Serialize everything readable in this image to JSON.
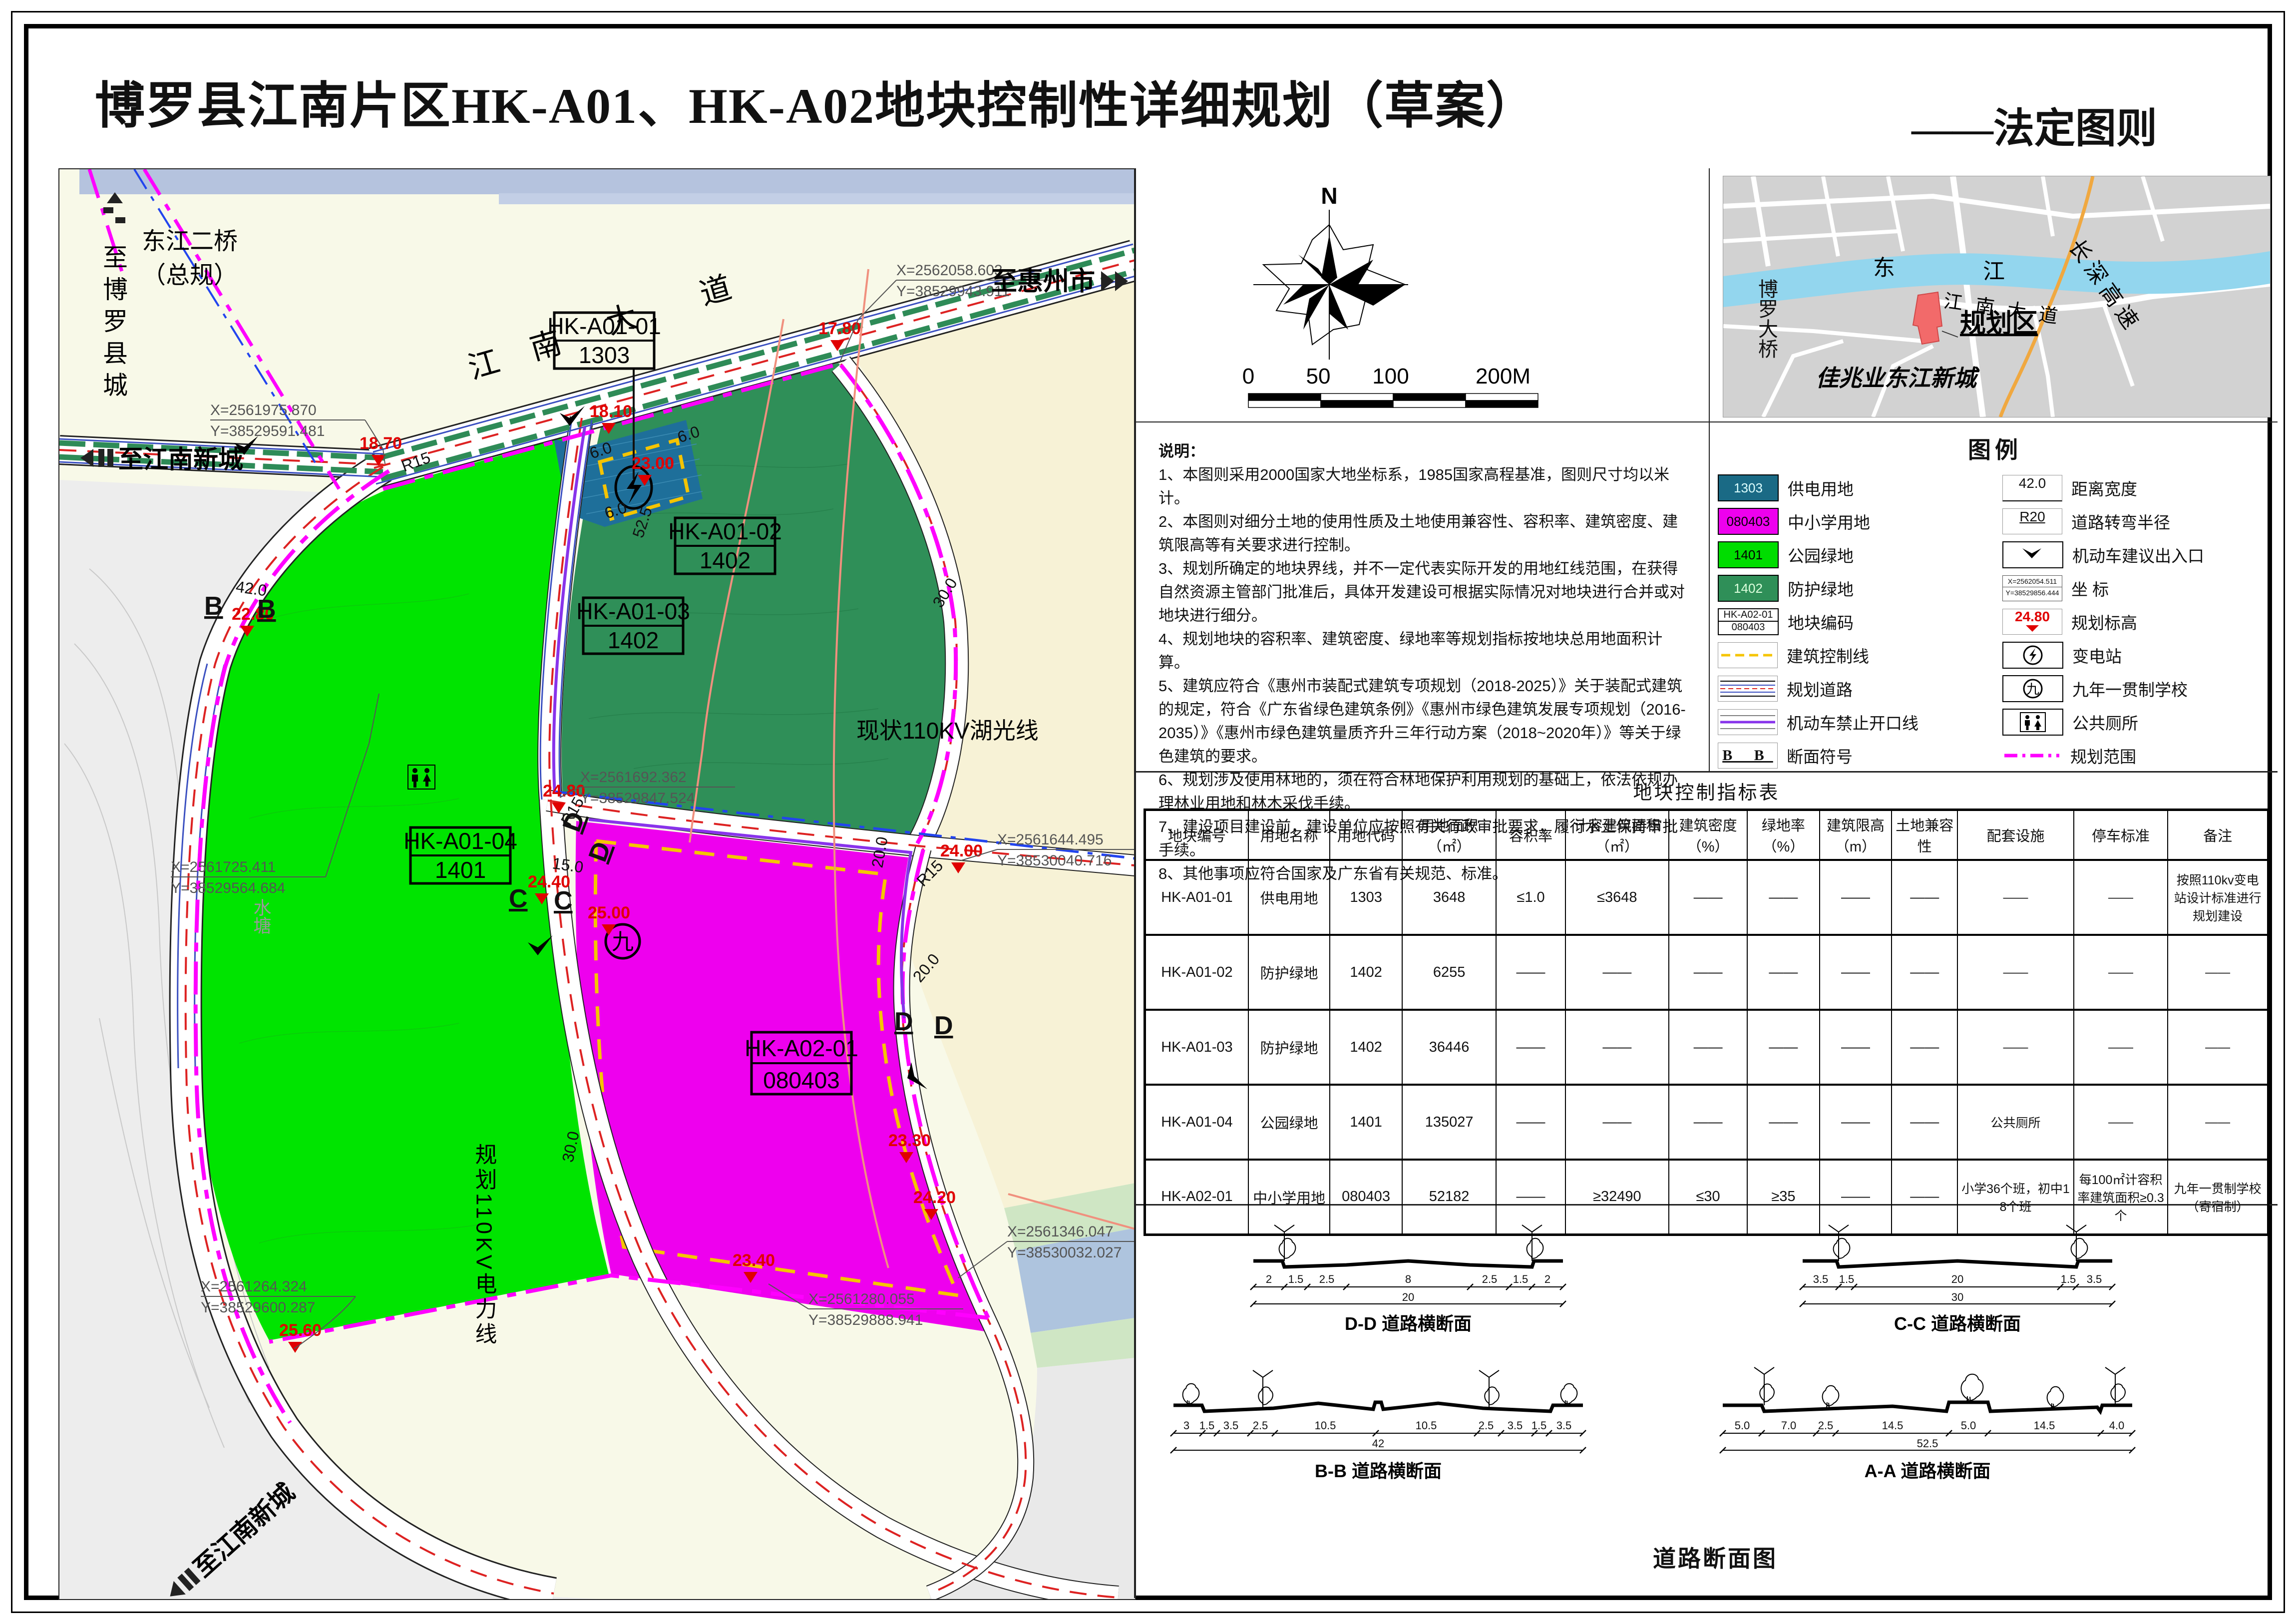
{
  "title": {
    "main": "博罗县江南片区HK-A01、HK-A02地块控制性详细规划（草案）",
    "sub": "——法定图则"
  },
  "map": {
    "t_boluo": "至博罗县城",
    "bridge1": "东江二桥",
    "bridge2": "（总规）",
    "t_huizhou": "至惠州市",
    "t_jiangnan_top": "至江南新城",
    "t_jiangnan_bot": "至江南新城",
    "road1": "江",
    "road2": "南",
    "road3": "大",
    "road4": "道",
    "huguang": "现状110KV湖光线",
    "powerline": "规划110KV电力线",
    "pond": "水塘",
    "nine": "九",
    "plots": {
      "p1c": "HK-A01-01",
      "p1u": "1303",
      "p2c": "HK-A01-02",
      "p2u": "1402",
      "p3c": "HK-A01-03",
      "p3u": "1402",
      "p4c": "HK-A01-04",
      "p4u": "1401",
      "p5c": "HK-A02-01",
      "p5u": "080403"
    },
    "elev": {
      "e1": "18.70",
      "e2": "18.10",
      "e3": "17.80",
      "e4": "23.00",
      "e5": "22.80",
      "e6": "24.80",
      "e7": "24.40",
      "e8": "25.00",
      "e9": "24.00",
      "e10": "23.30",
      "e11": "24.20",
      "e12": "23.40",
      "e13": "25.60"
    },
    "coords": {
      "c1x": "X=2562058.603",
      "c1y": "Y=38529943.911",
      "c2x": "X=2561975.870",
      "c2y": "Y=38529591.481",
      "c3x": "X=2561725.411",
      "c3y": "Y=38529564.684",
      "c4x": "X=2561692.362",
      "c4y": "Y=38529847.524",
      "c5x": "X=2561644.495",
      "c5y": "Y=38530040.716",
      "c6x": "X=2561346.047",
      "c6y": "Y=38530032.027",
      "c7x": "X=2561280.055",
      "c7y": "Y=38529888.941",
      "c8x": "X=2561264.324",
      "c8y": "Y=38529600.287"
    },
    "dims": {
      "d42": "42.0",
      "d525": "52.5",
      "d30a": "30.0",
      "d30b": "30.0",
      "d20a": "20.0",
      "d20b": "20.0",
      "d15": "15.0",
      "d6a": "6.0",
      "d6b": "6.0",
      "d6c": "6.0",
      "r15a": "R15",
      "r15b": "R15",
      "r15c": "R15"
    },
    "secletters": {
      "b": "B",
      "c": "C",
      "d": "D"
    }
  },
  "compass": {
    "north": "N",
    "s0": "0",
    "s50": "50",
    "s100": "100",
    "s200": "200M"
  },
  "locator": {
    "river1": "东",
    "river2": "江",
    "bridge": "博罗大桥",
    "road": "江南大道",
    "highway": "长深高速",
    "zone": "规划区",
    "city": "佳兆业东江新城"
  },
  "notes": {
    "heading": "说明：",
    "items": [
      "1、本图则采用2000国家大地坐标系，1985国家高程基准，图则尺寸均以米计。",
      "2、本图则对细分土地的使用性质及土地使用兼容性、容积率、建筑密度、建筑限高等有关要求进行控制。",
      "3、规划所确定的地块界线，并不一定代表实际开发的用地红线范围，在获得自然资源主管部门批准后，具体开发建设可根据实际情况对地块进行合并或对地块进行细分。",
      "4、规划地块的容积率、建筑密度、绿地率等规划指标按地块总用地面积计算。",
      "5、建筑应符合《惠州市装配式建筑专项规划（2018-2025）》关于装配式建筑的规定，符合《广东省绿色建筑条例》《惠州市绿色建筑发展专项规划（2016-2035）》《惠州市绿色建筑量质齐升三年行动方案（2018~2020年）》等关于绿色建筑的要求。",
      "6、规划涉及使用林地的，须在符合林地保护利用规划的基础上，依法依规办理林业用地和林木采伐手续。",
      "7、建设项目建设前，建设单位应按照有关行政审批要求，履行水土保持审批手续。",
      "8、其他事项应符合国家及广东省有关规范、标准。"
    ]
  },
  "legend": {
    "heading": "图例",
    "z1code": "1303",
    "z1": "供电用地",
    "z2code": "080403",
    "z2": "中小学用地",
    "z3code": "1401",
    "z3": "公园绿地",
    "z4code": "1402",
    "z4": "防护绿地",
    "plot_top": "HK-A02-01",
    "plot_bot": "080403",
    "plot": "地块编码",
    "ctrl": "建筑控制线",
    "road": "规划道路",
    "noopen": "机动车禁止开口线",
    "sec_sym": "B B",
    "sec": "断面符号",
    "dim_sym": "42.0",
    "dim": "距离宽度",
    "radius_sym": "R20",
    "radius": "道路转弯半径",
    "entry": "机动车建议出入口",
    "coord_x": "X=2562054.511",
    "coord_y": "Y=38529856.444",
    "coord": "坐  标",
    "elev_sym": "24.80",
    "elev": "规划标高",
    "sub": "变电站",
    "nine_sym": "九",
    "nine": "九年一贯制学校",
    "wc": "公共厕所",
    "range": "规划范围"
  },
  "table": {
    "title": "地块控制指标表",
    "headers": [
      "地块编号",
      "用地名称",
      "用地代码",
      "用地面积（㎡）",
      "容积率",
      "计容建筑面积（㎡）",
      "建筑密度（%）",
      "绿地率（%）",
      "建筑限高（m）",
      "土地兼容性",
      "配套设施",
      "停车标准",
      "备注"
    ],
    "rows": [
      {
        "code": "HK-A01-01",
        "name": "供电用地",
        "ucode": "1303",
        "area": "3648",
        "far": "≤1.0",
        "gfa": "≤3648",
        "density": "——",
        "green": "——",
        "height": "——",
        "compat": "——",
        "fac": "——",
        "park": "——",
        "remark": "按照110kv变电站设计标准进行规划建设"
      },
      {
        "code": "HK-A01-02",
        "name": "防护绿地",
        "ucode": "1402",
        "area": "6255",
        "far": "——",
        "gfa": "——",
        "density": "——",
        "green": "——",
        "height": "——",
        "compat": "——",
        "fac": "——",
        "park": "——",
        "remark": "——"
      },
      {
        "code": "HK-A01-03",
        "name": "防护绿地",
        "ucode": "1402",
        "area": "36446",
        "far": "——",
        "gfa": "——",
        "density": "——",
        "green": "——",
        "height": "——",
        "compat": "——",
        "fac": "——",
        "park": "——",
        "remark": "——"
      },
      {
        "code": "HK-A01-04",
        "name": "公园绿地",
        "ucode": "1401",
        "area": "135027",
        "far": "——",
        "gfa": "——",
        "density": "——",
        "green": "——",
        "height": "——",
        "compat": "——",
        "fac": "公共厕所",
        "park": "——",
        "remark": "——"
      },
      {
        "code": "HK-A02-01",
        "name": "中小学用地",
        "ucode": "080403",
        "area": "52182",
        "far": "——",
        "gfa": "≥32490",
        "density": "≤30",
        "green": "≥35",
        "height": "——",
        "compat": "——",
        "fac": "小学36个班，初中18个班",
        "park": "每100㎡计容积率建筑面积≥0.3个",
        "remark": "九年一贯制学校（寄宿制）"
      }
    ]
  },
  "roadsec": {
    "caption": "道路断面图",
    "dd": {
      "title": "D-D 道路横断面",
      "segs": [
        "2",
        "1.5",
        "2.5",
        "8",
        "2.5",
        "1.5",
        "2"
      ],
      "total": "20"
    },
    "cc": {
      "title": "C-C 道路横断面",
      "segs": [
        "3.5",
        "1.5",
        "20",
        "1.5",
        "3.5"
      ],
      "total": "30"
    },
    "bb": {
      "title": "B-B 道路横断面",
      "segs": [
        "3",
        "1.5",
        "3.5",
        "2.5",
        "10.5",
        "10.5",
        "2.5",
        "3.5",
        "1.5",
        "3.5"
      ],
      "total": "42"
    },
    "aa": {
      "title": "A-A 道路横断面",
      "segs": [
        "5.0",
        "7.0",
        "2.5",
        "14.5",
        "5.0",
        "14.5",
        "4.0"
      ],
      "total": "52.5"
    }
  }
}
